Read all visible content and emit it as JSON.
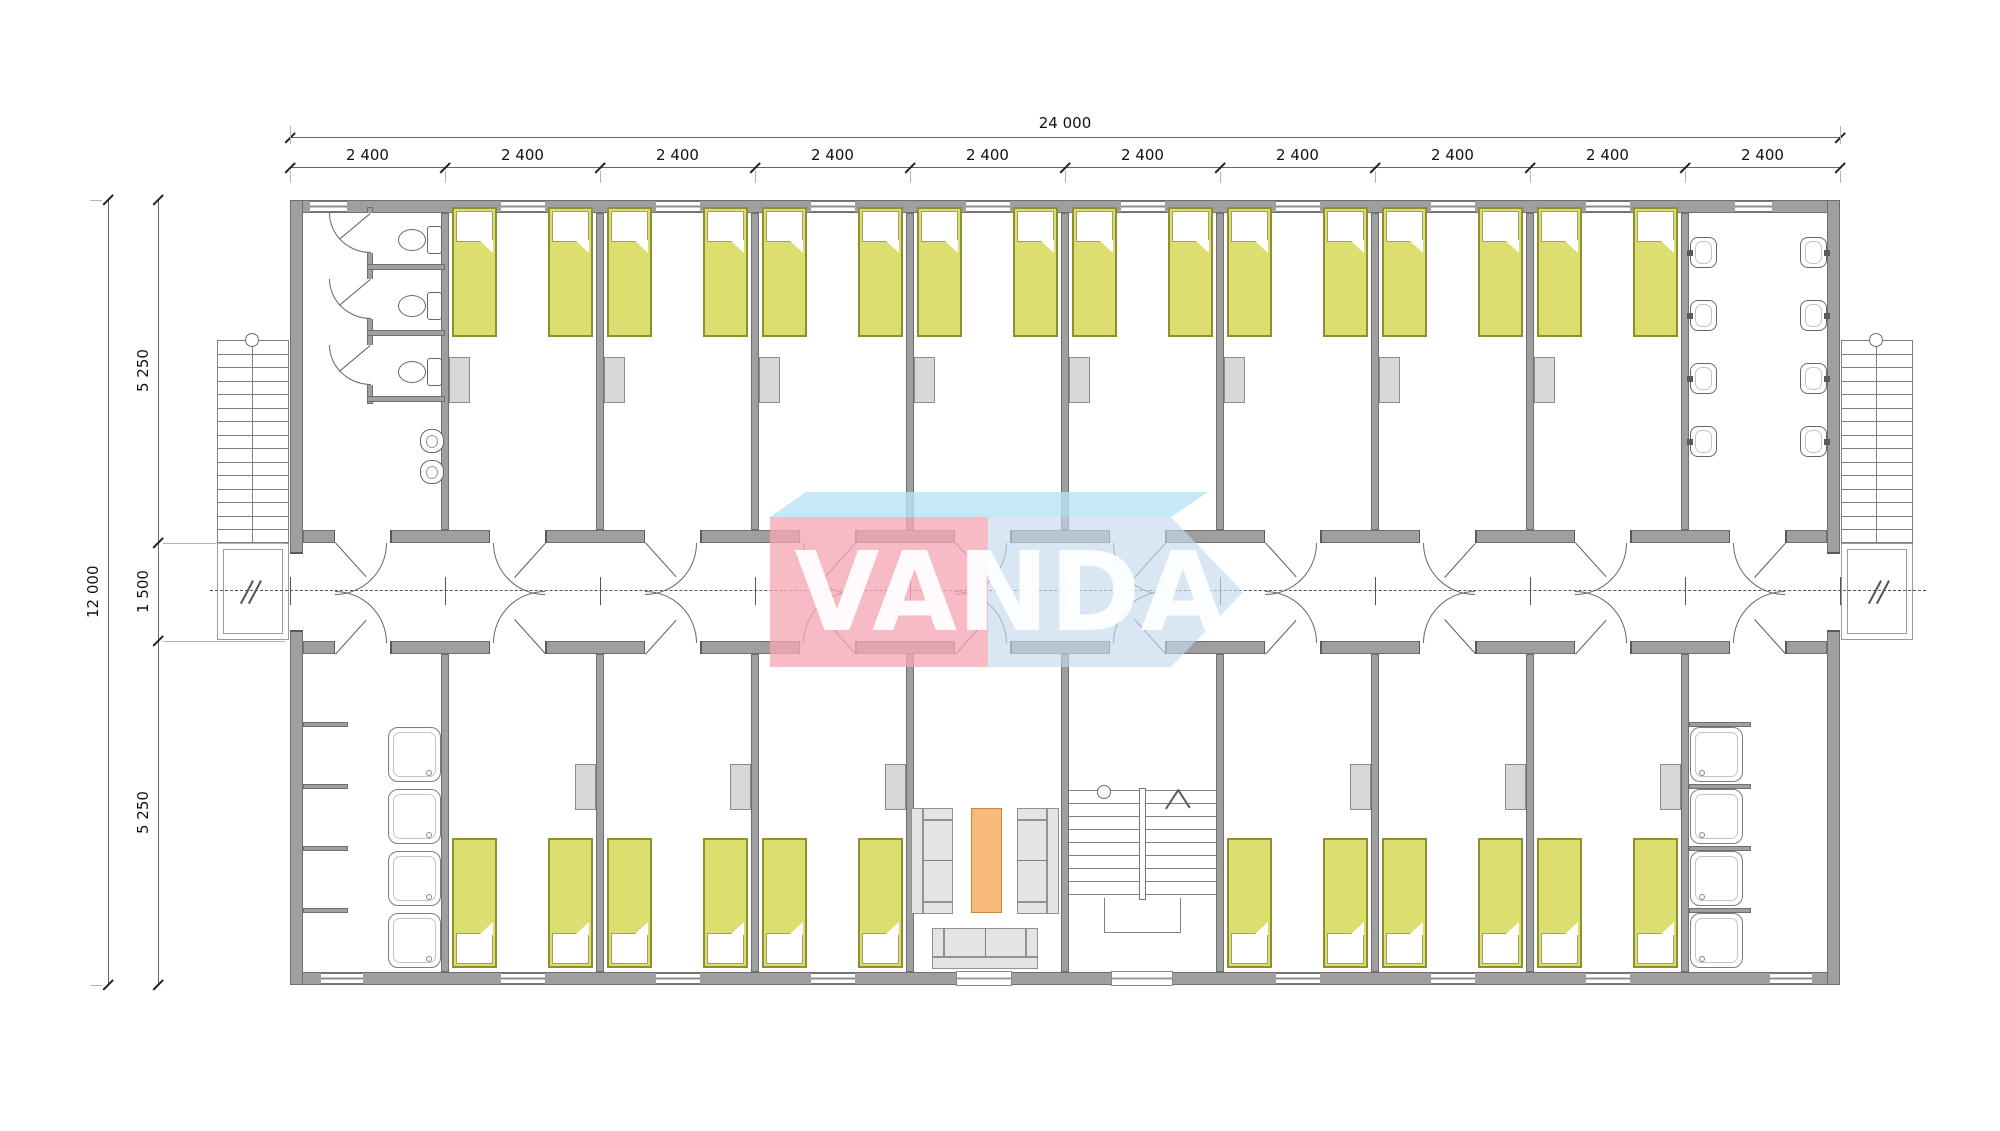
{
  "logo": {
    "text": "VANDA",
    "front_color": "#f3a8b5",
    "top_color": "#b9e2f4",
    "side_color": "#c6dbee",
    "letter_color": "#ffffff"
  },
  "dimensions": {
    "top_total": "24 000",
    "top_segments": [
      "2 400",
      "2 400",
      "2 400",
      "2 400",
      "2 400",
      "2 400",
      "2 400",
      "2 400",
      "2 400",
      "2 400"
    ],
    "left_total": "12 000",
    "left_segments": [
      "5 250",
      "1 500",
      "5 250"
    ]
  },
  "plan": {
    "bed_color": "#dcde6f",
    "wall_color": "#9f9f9f",
    "table_color": "#f7ba7b",
    "module_count": 10,
    "top_bedroom_beds": 16,
    "bottom_bedroom_beds": 12,
    "toilet_stalls": 3,
    "urinals": 2,
    "wash_basins": 8,
    "shower_trays": 8
  }
}
